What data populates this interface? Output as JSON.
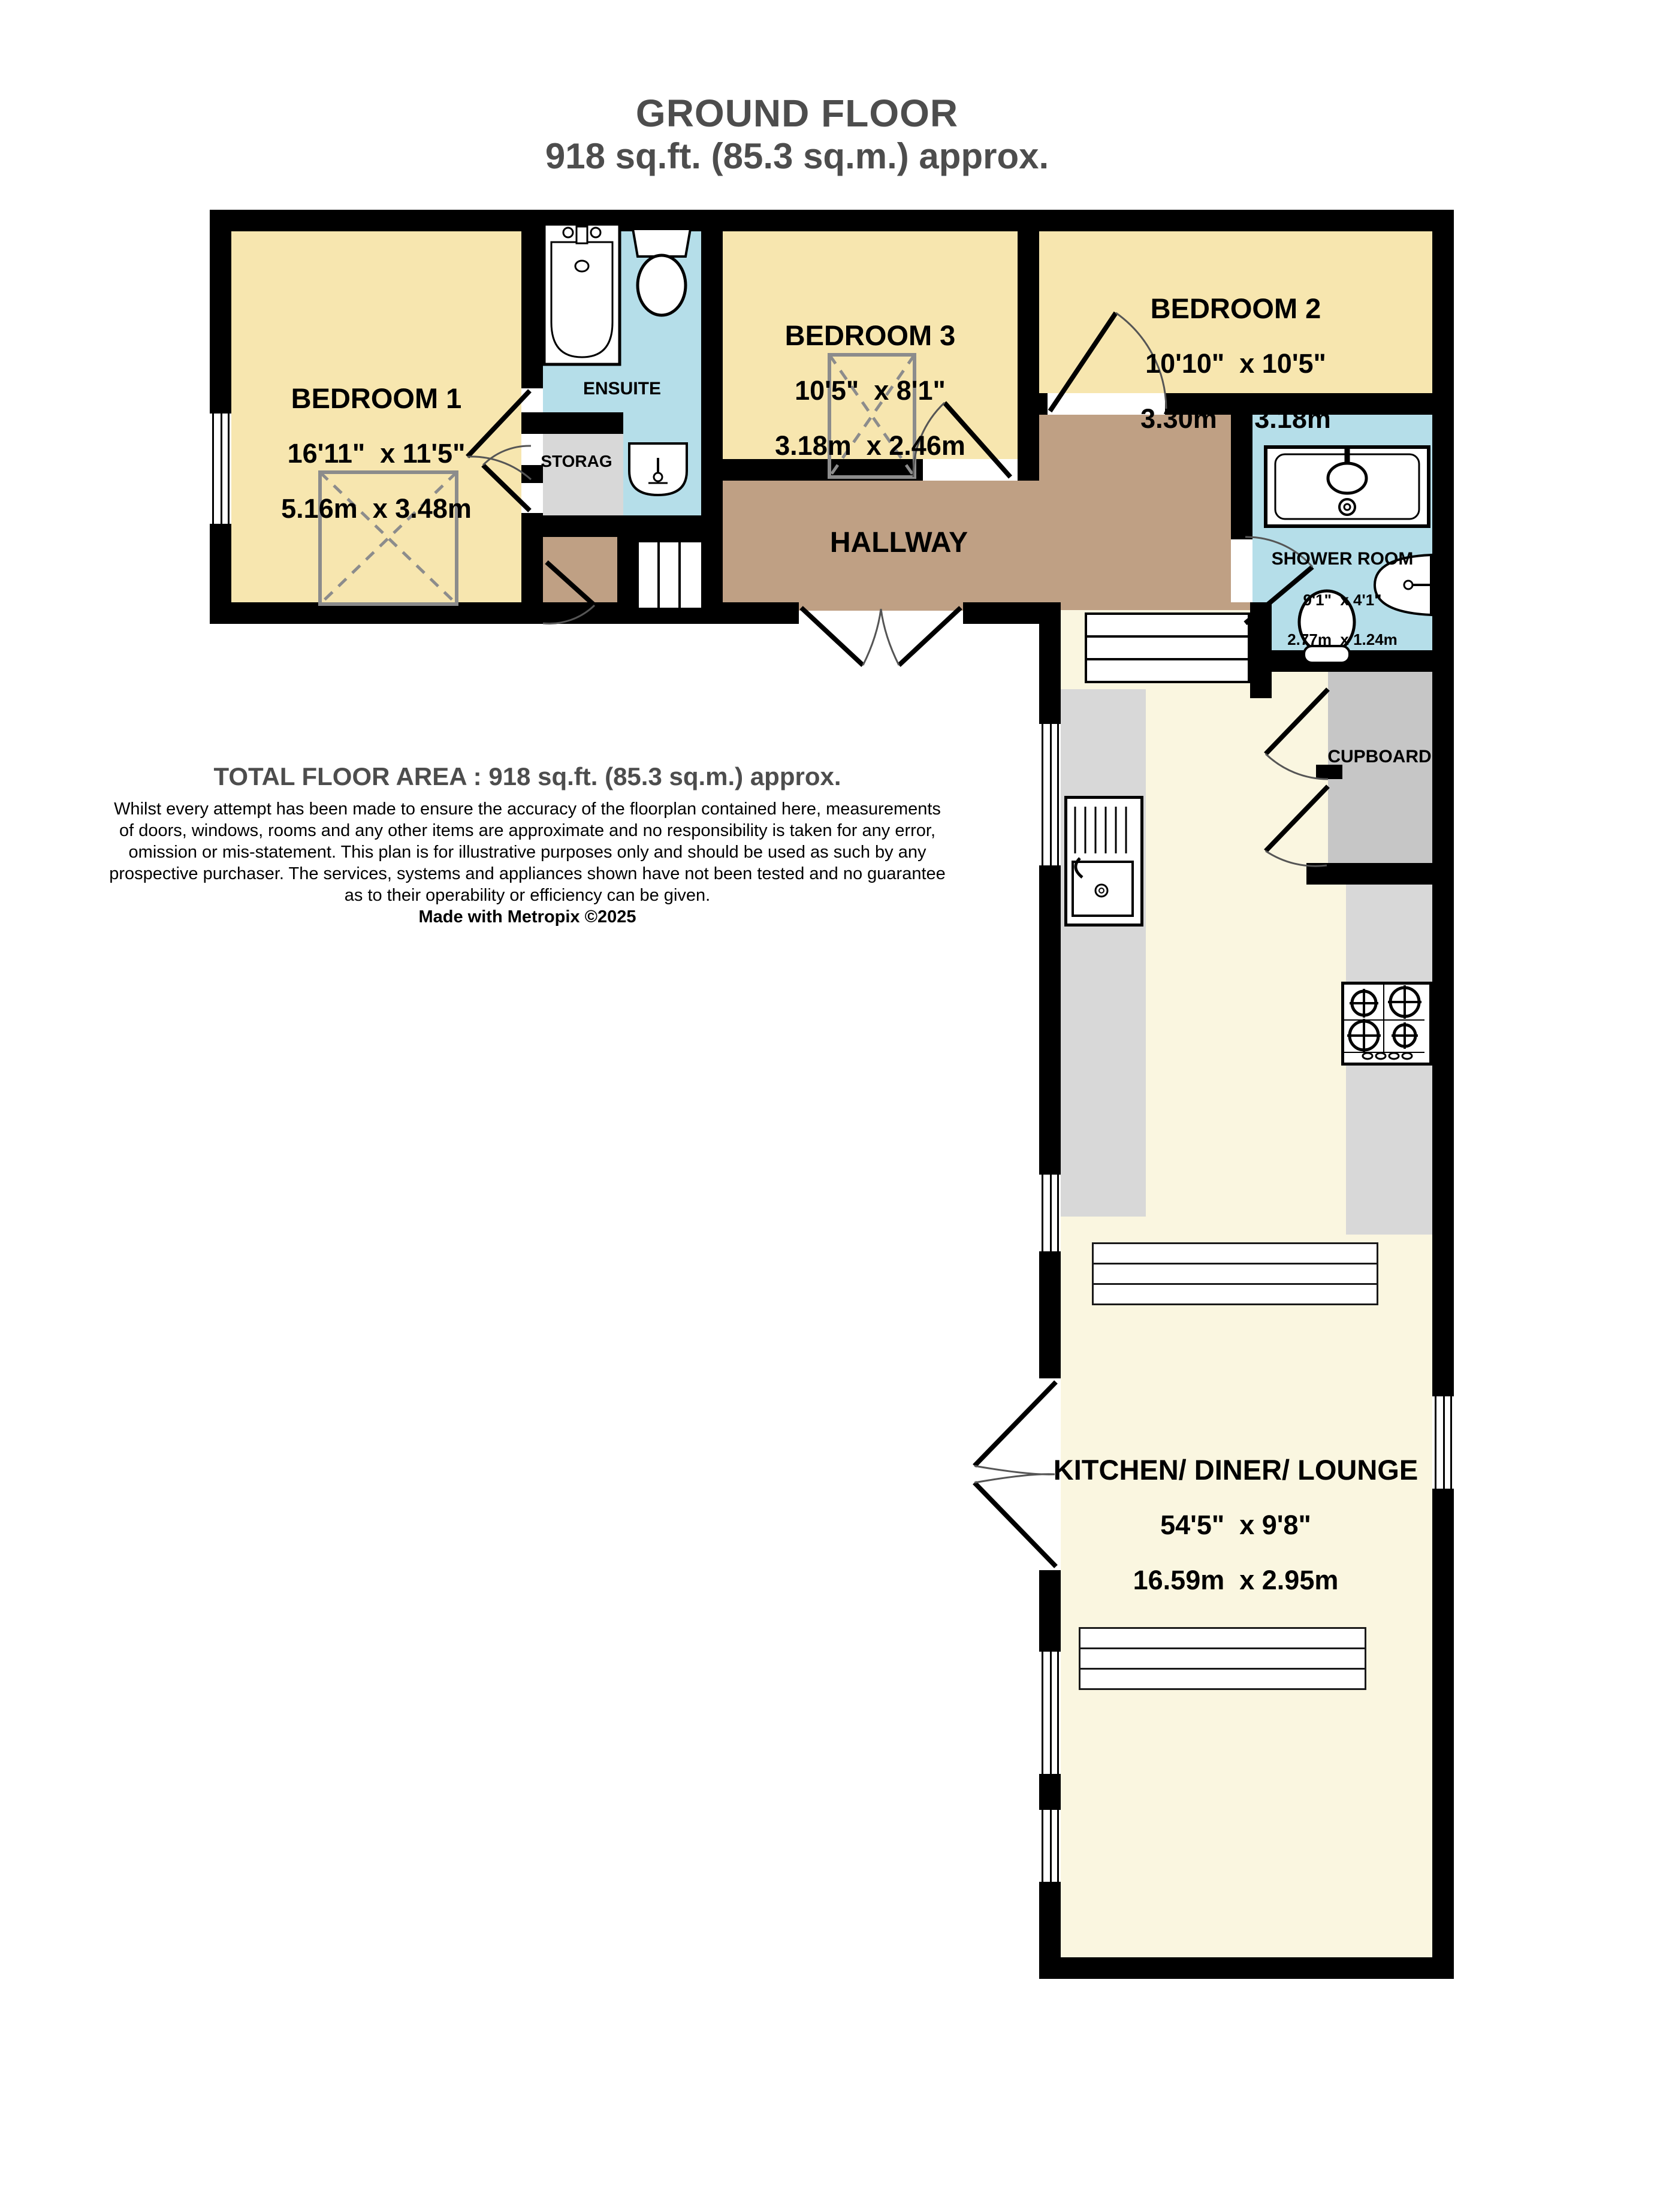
{
  "title": {
    "line1": "GROUND FLOOR",
    "line2": "918 sq.ft. (85.3 sq.m.) approx."
  },
  "rooms": {
    "bedroom1": {
      "name": "BEDROOM 1",
      "imperial": "16'11\"  x 11'5\"",
      "metric": "5.16m  x 3.48m"
    },
    "bedroom3": {
      "name": "BEDROOM 3",
      "imperial": "10'5\"  x 8'1\"",
      "metric": "3.18m  x 2.46m"
    },
    "bedroom2": {
      "name": "BEDROOM 2",
      "imperial": "10'10\"  x 10'5\"",
      "metric": "3.30m  x 3.18m"
    },
    "shower": {
      "name": "SHOWER ROOM",
      "imperial": "9'1\"  x 4'1\"",
      "metric": "2.77m  x 1.24m"
    },
    "kitchen": {
      "name": "KITCHEN/ DINER/ LOUNGE",
      "imperial": "54'5\"  x 9'8\"",
      "metric": "16.59m  x 2.95m"
    },
    "ensuite": {
      "name": "ENSUITE"
    },
    "storage": {
      "name": "STORAG"
    },
    "hallway": {
      "name": "HALLWAY"
    },
    "cupboard": {
      "name": "CUPBOARD"
    }
  },
  "footer": {
    "total": "TOTAL FLOOR AREA : 918 sq.ft. (85.3 sq.m.) approx.",
    "disclaimer": "Whilst every attempt has been made to ensure the accuracy of the floorplan contained here, measurements\nof doors, windows, rooms and any other items are approximate and no responsibility is taken for any error,\nomission or mis-statement. This plan is for illustrative purposes only and should be used as such by any\nprospective purchaser. The services, systems and appliances shown have not been tested and no guarantee\nas to their operability or efficiency can be given.",
    "credit": "Made with Metropix ©2025"
  },
  "fixtures": [
    "bath",
    "toilet",
    "basin",
    "shower-tray",
    "shower-head",
    "kitchen-sink",
    "gas-hob",
    "stairs",
    "steps",
    "wardrobe",
    "table",
    "window",
    "door-swing"
  ],
  "colors": {
    "wall": "#000000",
    "bedroom_fill": "#F7E6AF",
    "bathroom_fill": "#B5DEE9",
    "hallway_fill": "#BFA084",
    "kitchen_fill": "#FAF6E0",
    "storage_fill": "#D8D8D8",
    "cupboard_fill": "#C6C6C6",
    "title_text": "#4D4D4D"
  }
}
